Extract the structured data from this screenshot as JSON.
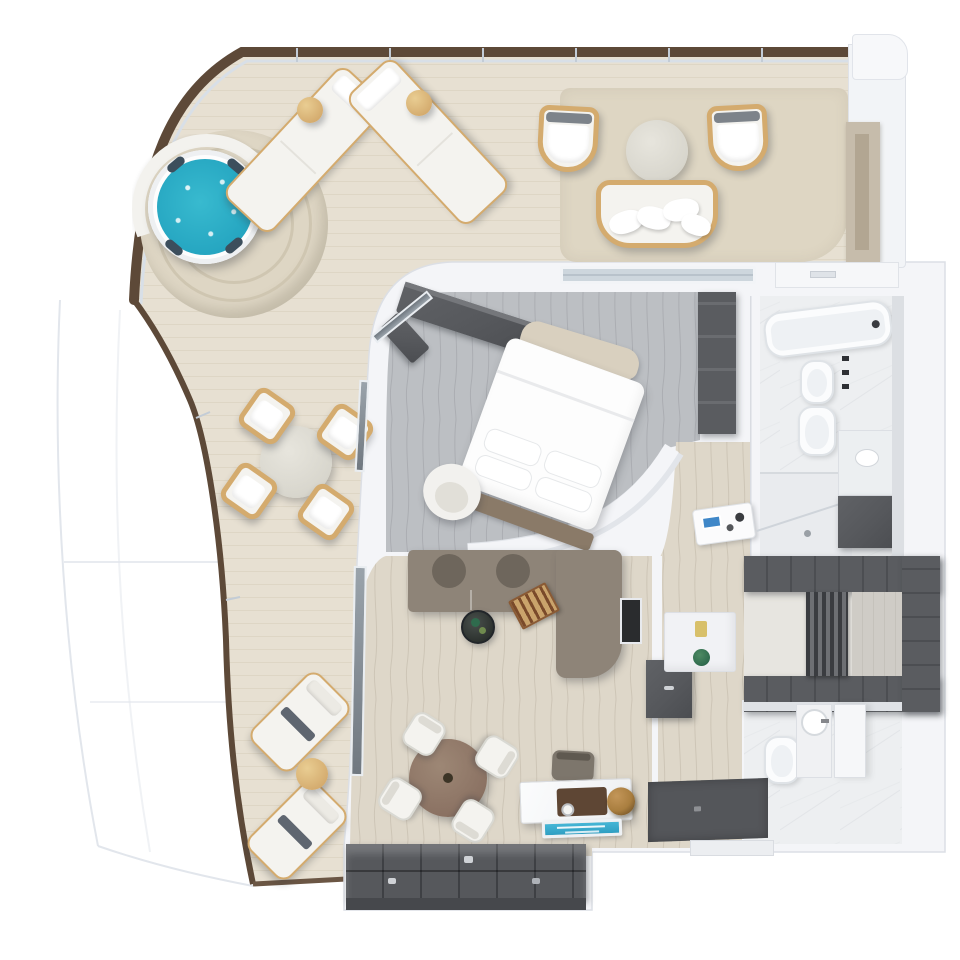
{
  "meta": {
    "kind": "3d-floor-plan-render",
    "subject": "luxury ship suite with curved private terrace",
    "canvas": {
      "width": 960,
      "height": 960
    },
    "visible_text": "none (decorative plaque text is illegible at render size)"
  },
  "palette": {
    "bg": "#ffffff",
    "deck": "#e7e0d2",
    "deckLine": "#d9d1bf",
    "deckRug": "#ded6c3",
    "railWood": "#5d4938",
    "railGlass": "#d8dfe7",
    "hullLine": "#e2e6ec",
    "wall": "#f4f5f8",
    "wallEdge": "#d9dce2",
    "floorGray": "#bcbfc3",
    "floorGrayLine": "#a6a9ae",
    "floorBeige": "#ded7c9",
    "floorBeigeLine": "#c9c1b1",
    "marble": "#edeff1",
    "marbleLine": "#d9dce0",
    "cabinetDark": "#56585c",
    "cabinetDarker": "#46484c",
    "sofa": "#8e8478",
    "sofaDark": "#6e665c",
    "woodTan": "#d4ab6e",
    "woodBrown": "#8b7263",
    "stone": "#d8d6cd",
    "water": "#38bacf",
    "waterDeep": "#23a3bf",
    "furnWhite": "#f4f3ef",
    "gold": "#a97e3f",
    "plaque": "#2f9ec2",
    "plant": "#2f6b4d",
    "glass": "#aeb8c2",
    "mat": "#54565a",
    "accentYellow": "#d8c06a",
    "tablet": "#3f87c8"
  },
  "rooms": [
    {
      "id": "terrace",
      "floor": "deck",
      "furniture": [
        {
          "name": "jacuzzi",
          "count": 1
        },
        {
          "name": "jacuzzi-platform-with-bench",
          "count": 1
        },
        {
          "name": "sun-lounger",
          "count": 2
        },
        {
          "name": "round-side-table",
          "count": 3
        },
        {
          "name": "outdoor-armchair",
          "count": 2
        },
        {
          "name": "outdoor-sofa",
          "count": 1
        },
        {
          "name": "round-coffee-table",
          "count": 1
        },
        {
          "name": "outdoor-dining-table",
          "count": 1
        },
        {
          "name": "outdoor-dining-chair",
          "count": 4
        },
        {
          "name": "cushioned-lounge-chair",
          "count": 2
        },
        {
          "name": "outdoor-rug",
          "count": 1
        },
        {
          "name": "bar-panel",
          "count": 1
        }
      ]
    },
    {
      "id": "bedroom",
      "floor": "floorGray",
      "furniture": [
        {
          "name": "double-bed",
          "count": 1
        },
        {
          "name": "foot-bench",
          "count": 1
        },
        {
          "name": "tv-console",
          "count": 2
        },
        {
          "name": "round-armchair",
          "count": 1
        },
        {
          "name": "nightstand-with-tablet",
          "count": 1
        },
        {
          "name": "closet",
          "count": 1
        }
      ]
    },
    {
      "id": "living-room",
      "floor": "floorBeige",
      "furniture": [
        {
          "name": "sectional-sofa",
          "count": 1
        },
        {
          "name": "backgammon-board",
          "count": 1
        },
        {
          "name": "round-coffee-table",
          "count": 1
        },
        {
          "name": "dining-table",
          "count": 1
        },
        {
          "name": "dining-chair",
          "count": 4
        },
        {
          "name": "writing-desk",
          "count": 1
        },
        {
          "name": "desk-chair",
          "count": 1
        },
        {
          "name": "gold-sphere-decor",
          "count": 1
        },
        {
          "name": "suite-plaque",
          "count": 1
        },
        {
          "name": "storage-wardrobe",
          "count": 1
        },
        {
          "name": "minibar",
          "count": 1
        },
        {
          "name": "vanity-niche-with-plant",
          "count": 1
        }
      ]
    },
    {
      "id": "bathroom-main",
      "floor": "marble",
      "furniture": [
        {
          "name": "bathtub",
          "count": 1
        },
        {
          "name": "bidet",
          "count": 1
        },
        {
          "name": "toilet",
          "count": 1
        },
        {
          "name": "vanity-cabinet",
          "count": 1
        },
        {
          "name": "shower",
          "count": 1
        }
      ]
    },
    {
      "id": "walk-in-closet",
      "floor": "marble",
      "furniture": [
        {
          "name": "u-shaped-wardrobe",
          "count": 1
        },
        {
          "name": "hanging-clothes-rail",
          "count": 1
        }
      ]
    },
    {
      "id": "bathroom-guest",
      "floor": "marble",
      "furniture": [
        {
          "name": "toilet",
          "count": 1
        },
        {
          "name": "round-washbasin",
          "count": 1
        },
        {
          "name": "shower-partition",
          "count": 1
        }
      ]
    },
    {
      "id": "foyer",
      "floor": "mat",
      "furniture": [
        {
          "name": "entry-mat",
          "count": 1
        }
      ]
    }
  ]
}
